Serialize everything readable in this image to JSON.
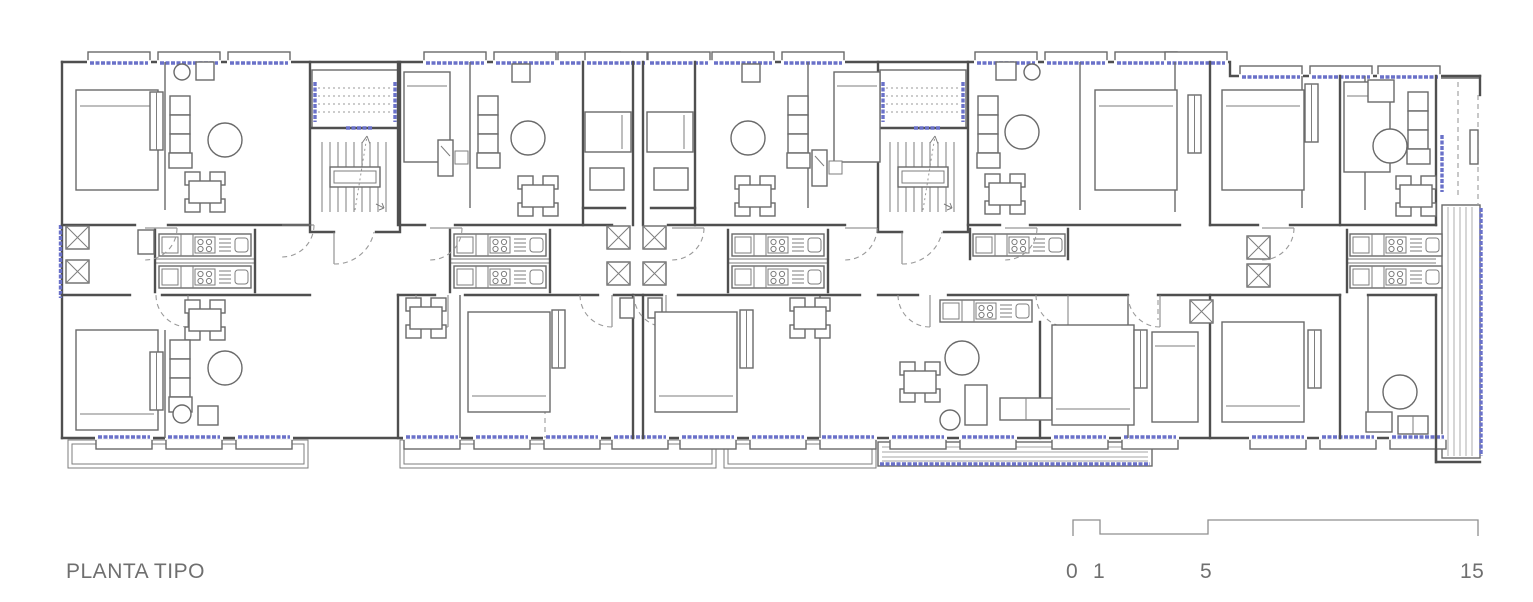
{
  "page": {
    "background": "#ffffff"
  },
  "drawing": {
    "title": "PLANTA TIPO",
    "type": "architectural-floor-plan-typical-storey"
  },
  "scale_bar": {
    "labels": [
      "0",
      "1",
      "5",
      "15"
    ]
  },
  "colors": {
    "wall_line": "#4f4f4f",
    "detail_line": "#6a6a6a",
    "light_line": "#8f8f8f",
    "window_glazing_blue": "#6a71c9",
    "hatch_line": "#a5a5a5",
    "label_text": "#6f6f6f",
    "background": "#ffffff"
  }
}
